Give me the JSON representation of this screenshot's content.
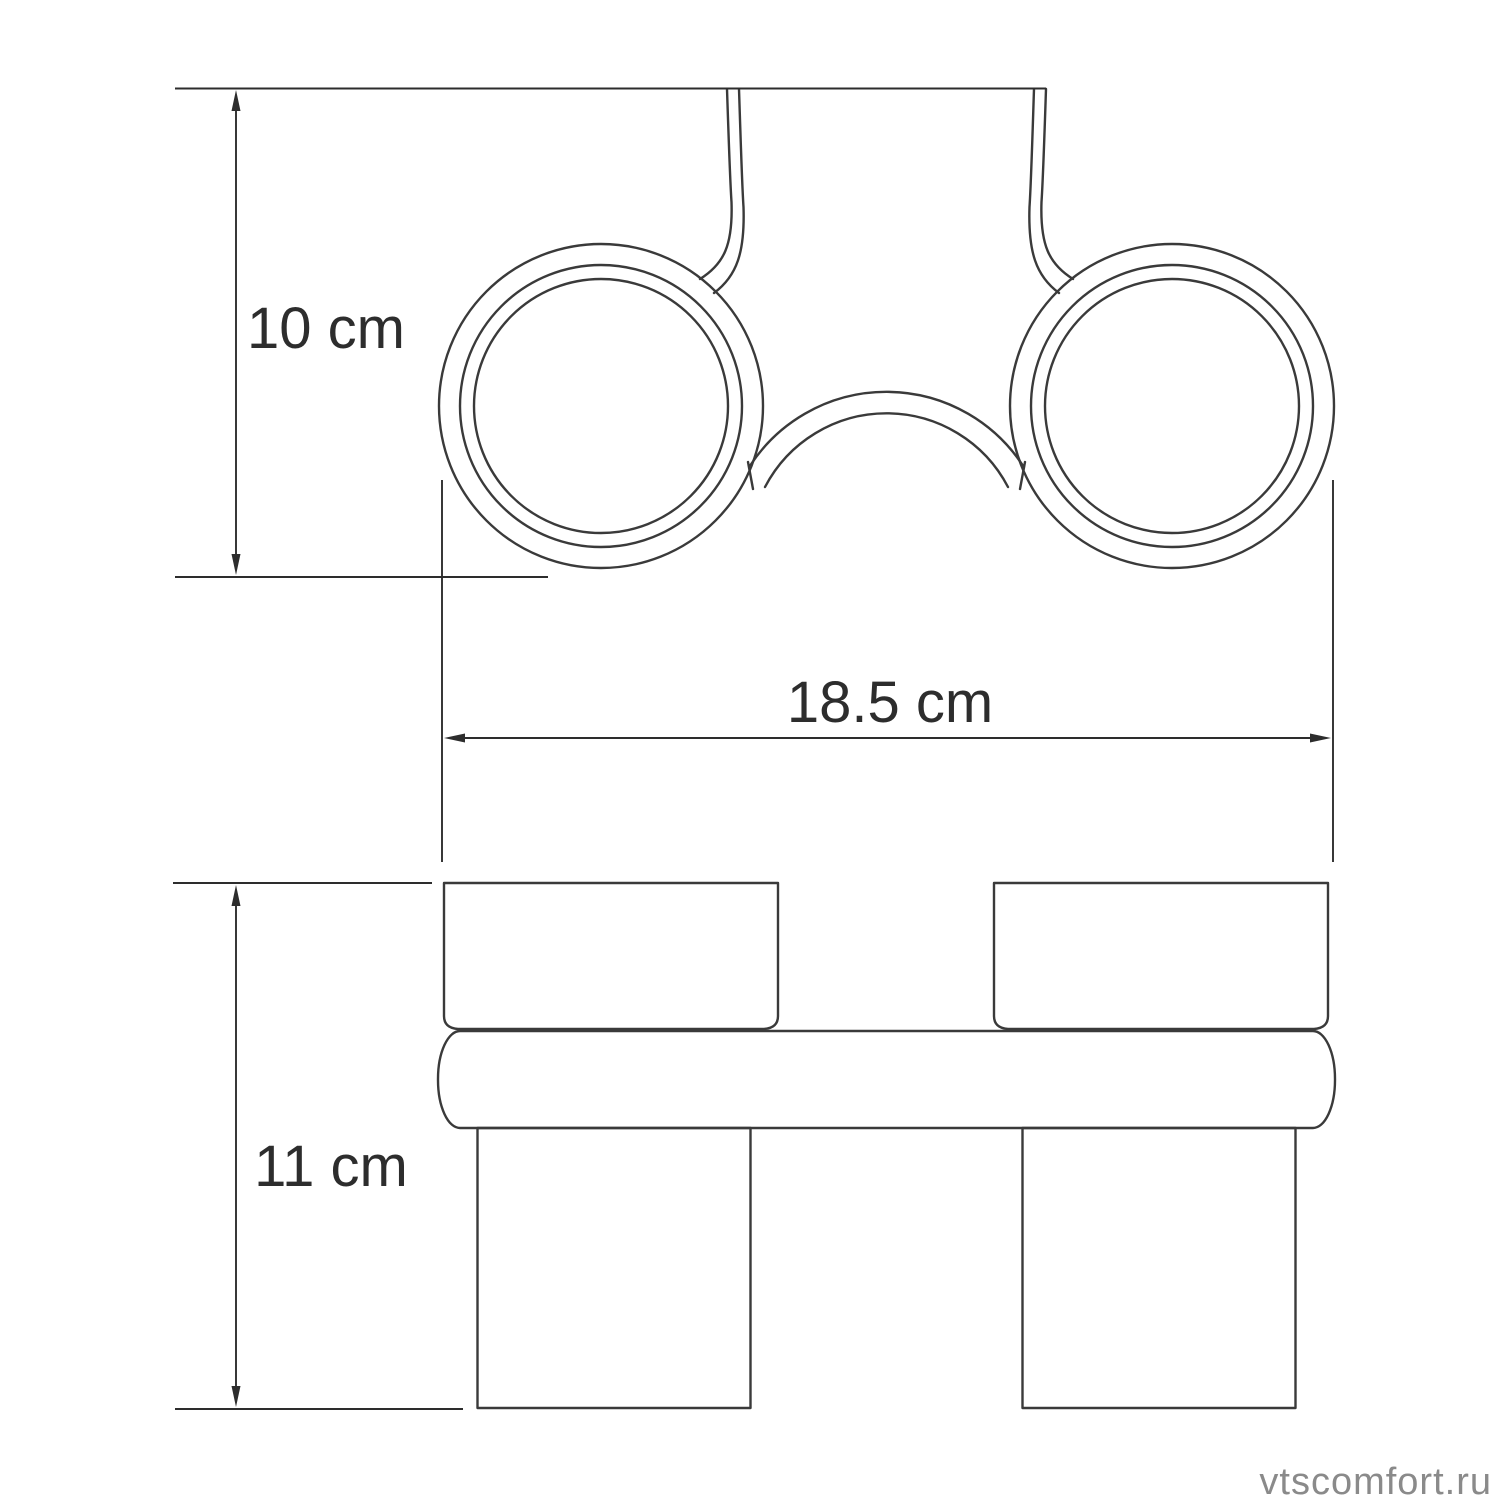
{
  "page": {
    "background_color": "#ffffff"
  },
  "drawing": {
    "line_color": "#3a3a3a",
    "dimension_color": "#2d2d2d"
  },
  "dimensions": {
    "top_view_height": "10 cm",
    "overall_width": "18.5 cm",
    "front_view_height": "11 cm"
  },
  "watermark": {
    "text": "vtscomfort.ru",
    "color": "#8a8a8a"
  }
}
